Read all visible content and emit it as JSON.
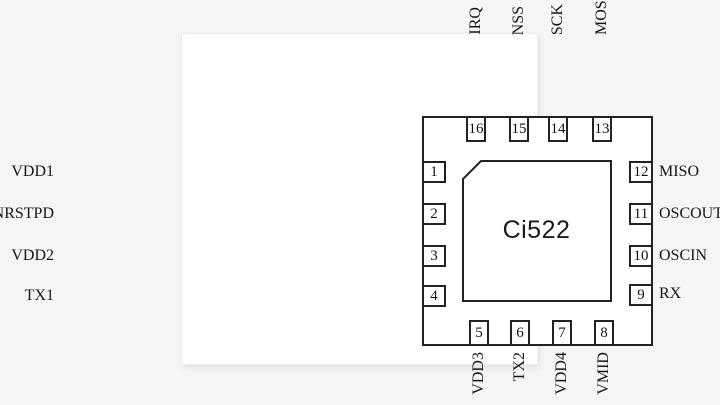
{
  "colors": {
    "page_background": "#f5f5f6",
    "card_background": "#ffffff",
    "line": "#222222",
    "text": "#161616"
  },
  "chip": {
    "label": "Ci522"
  },
  "pins": {
    "top": [
      {
        "num": "16",
        "name": "IRQ"
      },
      {
        "num": "15",
        "name": "NSS"
      },
      {
        "num": "14",
        "name": "SCK"
      },
      {
        "num": "13",
        "name": "MOSI"
      }
    ],
    "bottom": [
      {
        "num": "5",
        "name": "VDD3"
      },
      {
        "num": "6",
        "name": "TX2"
      },
      {
        "num": "7",
        "name": "VDD4"
      },
      {
        "num": "8",
        "name": "VMID"
      }
    ],
    "left": [
      {
        "num": "1",
        "name": "VDD1"
      },
      {
        "num": "2",
        "name": "NRSTPD"
      },
      {
        "num": "3",
        "name": "VDD2"
      },
      {
        "num": "4",
        "name": "TX1"
      }
    ],
    "right": [
      {
        "num": "12",
        "name": "MISO"
      },
      {
        "num": "11",
        "name": "OSCOUT"
      },
      {
        "num": "10",
        "name": "OSCIN"
      },
      {
        "num": "9",
        "name": "RX"
      }
    ]
  }
}
